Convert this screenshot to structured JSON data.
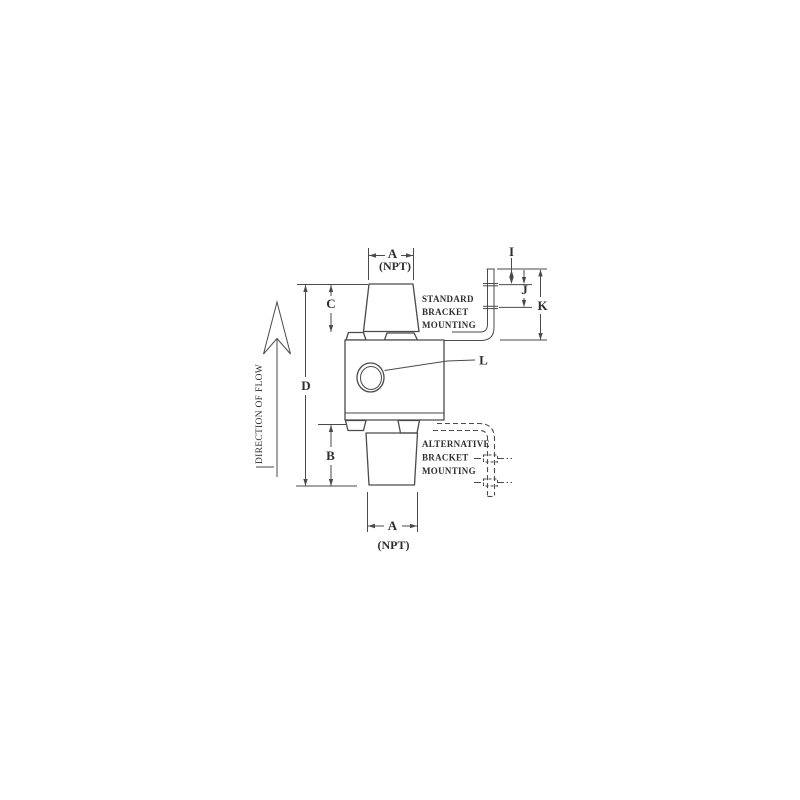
{
  "drawing": {
    "labels": {
      "dim_a_top": "A",
      "npt_top": "(NPT)",
      "dim_i": "I",
      "dim_j": "J",
      "dim_k": "K",
      "dim_c": "C",
      "dim_d": "D",
      "dim_b": "B",
      "dim_l": "L",
      "dim_a_bottom": "A",
      "npt_bottom": "(NPT)"
    },
    "annotations": {
      "standard_bracket": {
        "line1": "STANDARD",
        "line2": "BRACKET",
        "line3": "MOUNTING"
      },
      "alternative_bracket": {
        "line1": "ALTERNATIVE",
        "line2": "BRACKET",
        "line3": "MOUNTING"
      },
      "direction_of_flow": "DIRECTION OF FLOW"
    },
    "colors": {
      "line": "#4a4a4a",
      "background": "#ffffff"
    }
  }
}
